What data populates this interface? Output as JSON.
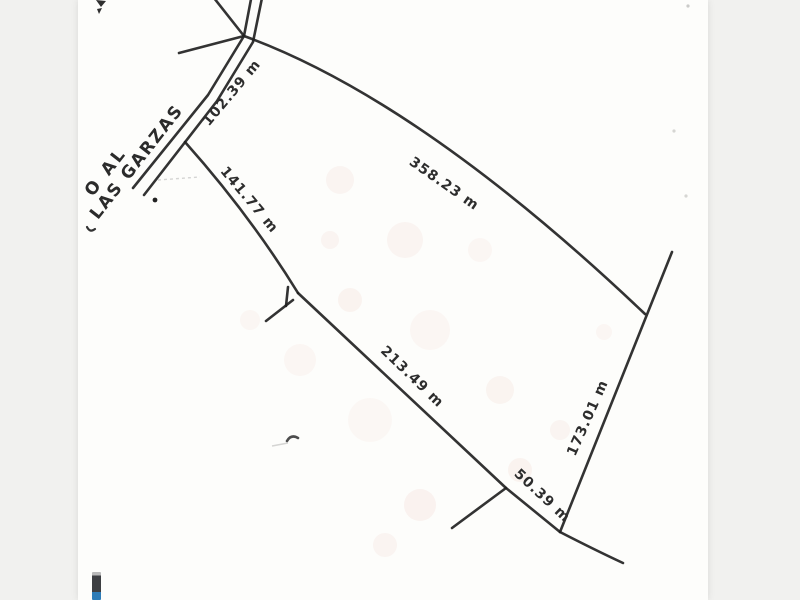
{
  "road": {
    "name_line1": "O AL",
    "name_line2": "LAS GARZAS"
  },
  "dimensions": {
    "road_frontage": "102.39 m",
    "northeast_side": "358.23 m",
    "west_side": "141.77 m",
    "south_side": "213.49 m",
    "east_side": "173.01 m",
    "southeast_side": "50.39 m"
  },
  "colors": {
    "ink": "#222222",
    "paper": "#fdfdfb",
    "margin": "#f1f1ef",
    "logo_dark": "#3d3f42",
    "logo_blue": "#2e7cb7"
  }
}
